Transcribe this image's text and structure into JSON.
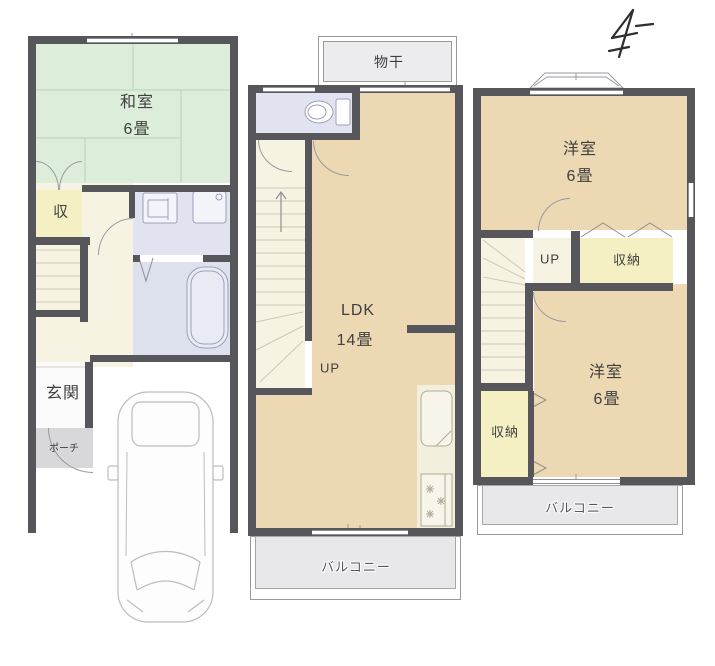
{
  "floorplans": {
    "first_floor": {
      "washitsu": {
        "label": "和室",
        "size": "6畳"
      },
      "closet_label": "収",
      "entrance_label": "玄関",
      "porch_label": "ポーチ"
    },
    "second_floor": {
      "drying_label": "物干",
      "ldk": {
        "label": "LDK",
        "size": "14畳"
      },
      "stairs_label": "UP",
      "balcony_label": "バルコニー"
    },
    "third_floor": {
      "bedroom_top": {
        "label": "洋室",
        "size": "6畳"
      },
      "stairs_label": "UP",
      "closet_top_label": "収納",
      "closet_bottom_label": "収納",
      "bedroom_bottom": {
        "label": "洋室",
        "size": "6畳"
      },
      "balcony_label": "バルコニー"
    },
    "colors": {
      "wall": "#57575b",
      "tatami_green": "#dcedd9",
      "wood_tan": "#ecd8b2",
      "closet_yellow": "#f4f0c4",
      "hall_cream": "#f6f3e3",
      "wet_area_lavender": "#e1e3f1",
      "bath_lavender": "#dde0ed",
      "balcony_gray": "#e8e8ea",
      "porch_gray": "#d8d8da",
      "text": "#3f3f3f"
    }
  }
}
